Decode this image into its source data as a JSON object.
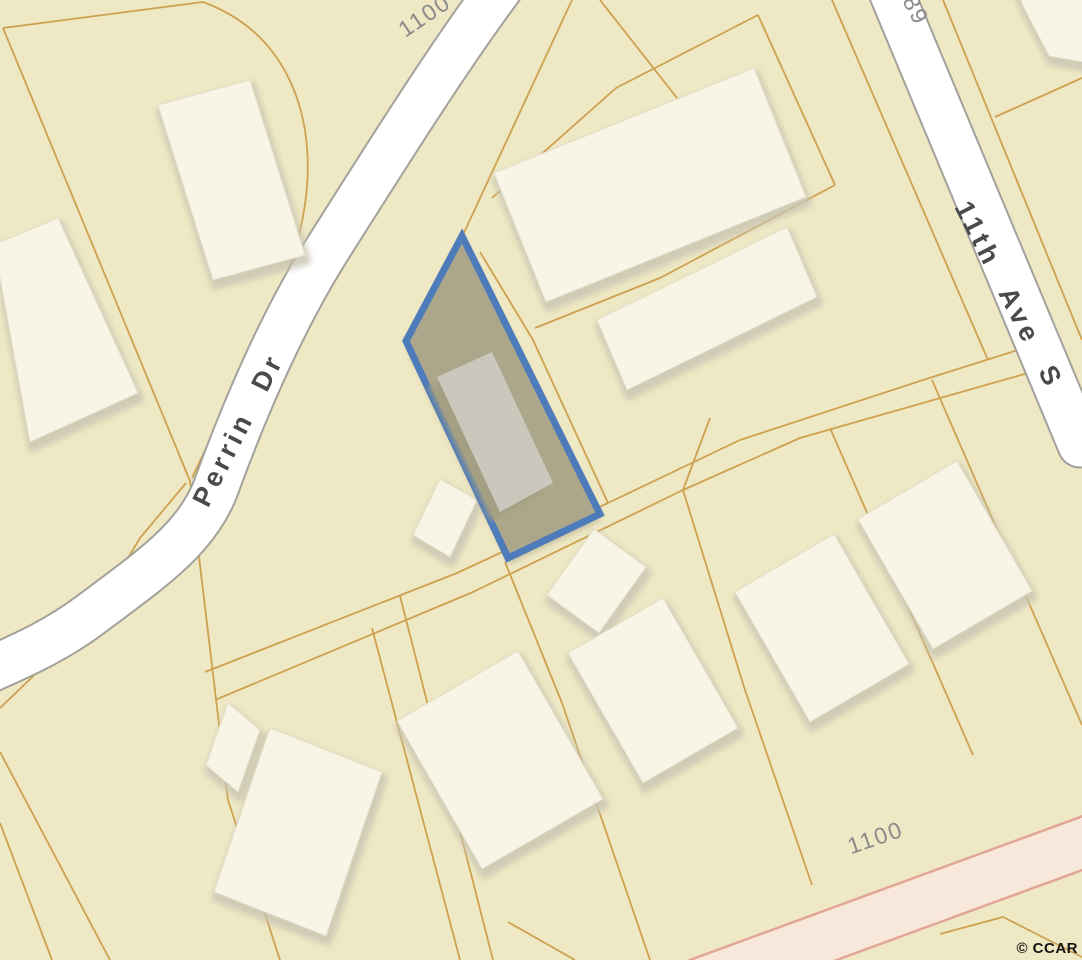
{
  "map": {
    "attribution": "© CCAR",
    "roads": {
      "perrin_dr": {
        "label": "Perrin Dr"
      },
      "eleventh_ave_s": {
        "label": "11th Ave S"
      }
    },
    "block_numbers": {
      "top": "1100",
      "bottom": "1100",
      "top_right_partial": "89"
    },
    "subject_parcel": {
      "highlighted": true,
      "border_color": "#4e7bb9",
      "fill_color": "#aca78a",
      "building_color": "#cac7bd"
    },
    "colors": {
      "background": "#efe8c4",
      "parcel_line": "#cda14f",
      "road_fill": "#ffffff",
      "road_edge": "#a3a19b",
      "building_fill": "#f8f5e6",
      "building_shadow": "#c9c5b2",
      "pink_road_fill": "#f8e8dc",
      "pink_road_border": "#e1a694",
      "block_number_color": "#8a8a8a",
      "road_label_color": "#4a4a4a",
      "attribution_color": "#141414"
    }
  }
}
